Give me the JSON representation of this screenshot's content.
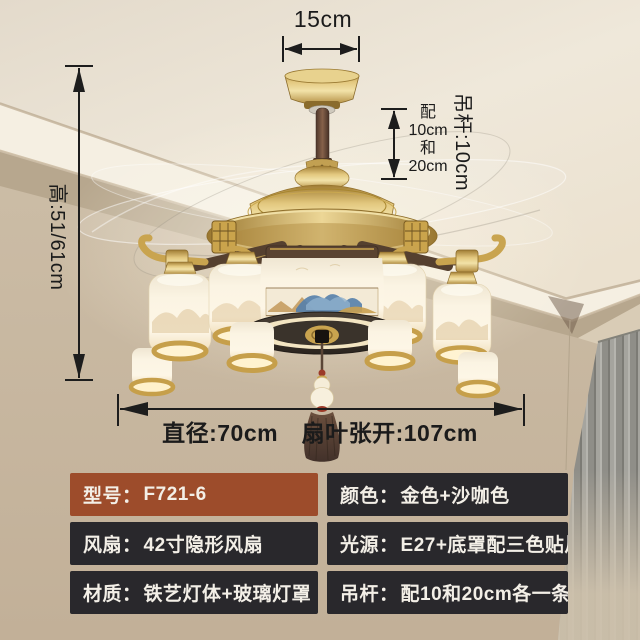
{
  "annotations": {
    "canopy_width": "15cm",
    "fixture_height": "高:51/61cm",
    "rod_length": "吊杆:10cm",
    "rod_options": "配\n10cm\n和\n20cm",
    "spread": "直径:70cm　扇叶张开:107cm"
  },
  "spec_table": {
    "rows": [
      {
        "label": "型号：",
        "value": "F721-6"
      },
      {
        "label": "颜色：",
        "value": "金色+沙咖色"
      },
      {
        "label": "风扇：",
        "value": "42寸隐形风扇"
      },
      {
        "label": "光源：",
        "value": "E27+底罩配三色贴片"
      },
      {
        "label": "材质：",
        "value": "铁艺灯体+玻璃灯罩"
      },
      {
        "label": "吊杆：",
        "value": "配10和20cm各一条"
      }
    ]
  },
  "colors": {
    "highlight_row": "#9d4c2b",
    "dark_row": "#29282c",
    "gold": "#c9a44f",
    "wood_brown": "#55402f",
    "arrow": "#1d1d1d"
  }
}
